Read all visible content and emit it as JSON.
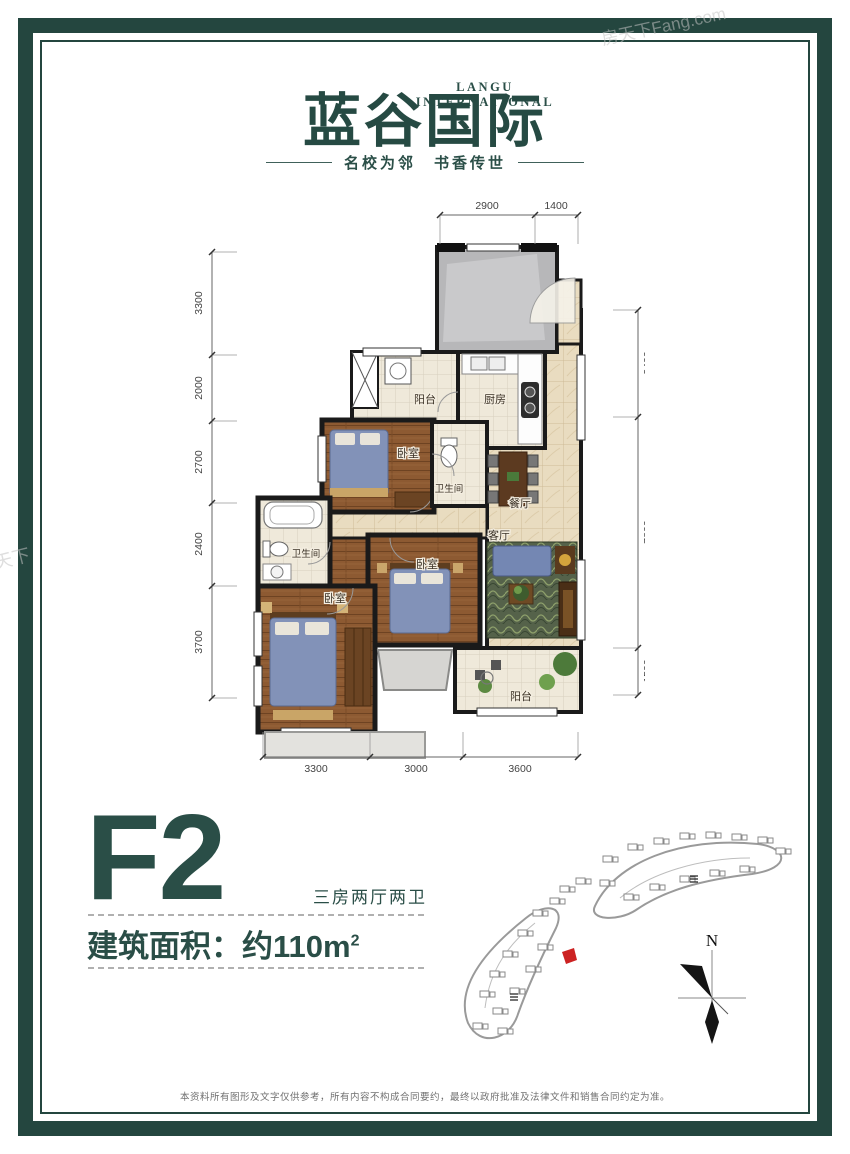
{
  "header": {
    "brand_en": "LANGU INTERNATIONAL",
    "brand_cn": "蓝谷国际",
    "tagline": "名校为邻　书香传世"
  },
  "watermarks": {
    "top_right": "房天下Fang.com",
    "left": "天下",
    "plan": "房天下"
  },
  "plan": {
    "rooms": {
      "balcony_top": "阳台",
      "kitchen": "厨房",
      "bedroom_top": "卧室",
      "bath_center": "卫生间",
      "dining": "餐厅",
      "bath_left": "卫生间",
      "living": "客厅",
      "bedroom_mid": "卧室",
      "bedroom_master": "卧室",
      "balcony_bottom": "阳台"
    },
    "dims_top": [
      "2900",
      "1400"
    ],
    "dims_bottom": [
      "3300",
      "3000",
      "3600"
    ],
    "dims_left": [
      "3300",
      "2000",
      "2700",
      "2400",
      "3700"
    ],
    "dims_right": [
      "3400",
      "7800",
      "1500"
    ]
  },
  "unit": {
    "code": "F2",
    "layout_desc": "三房两厅两卫",
    "area_prefix": "建筑面积：约110m",
    "area_sup": "2"
  },
  "sitemap": {
    "compass_label": "N"
  },
  "footer": {
    "disclaimer": "本资料所有图形及文字仅供参考，所有内容不构成合同要约，最终以政府批准及法律文件和销售合同约定为准。"
  },
  "colors": {
    "brand_teal": "#2a4e47",
    "frame_teal": "#24463f",
    "wood_floor": "#8d5a32",
    "marble_tile": "#e9dcc0",
    "marker_red": "#cc2222"
  }
}
